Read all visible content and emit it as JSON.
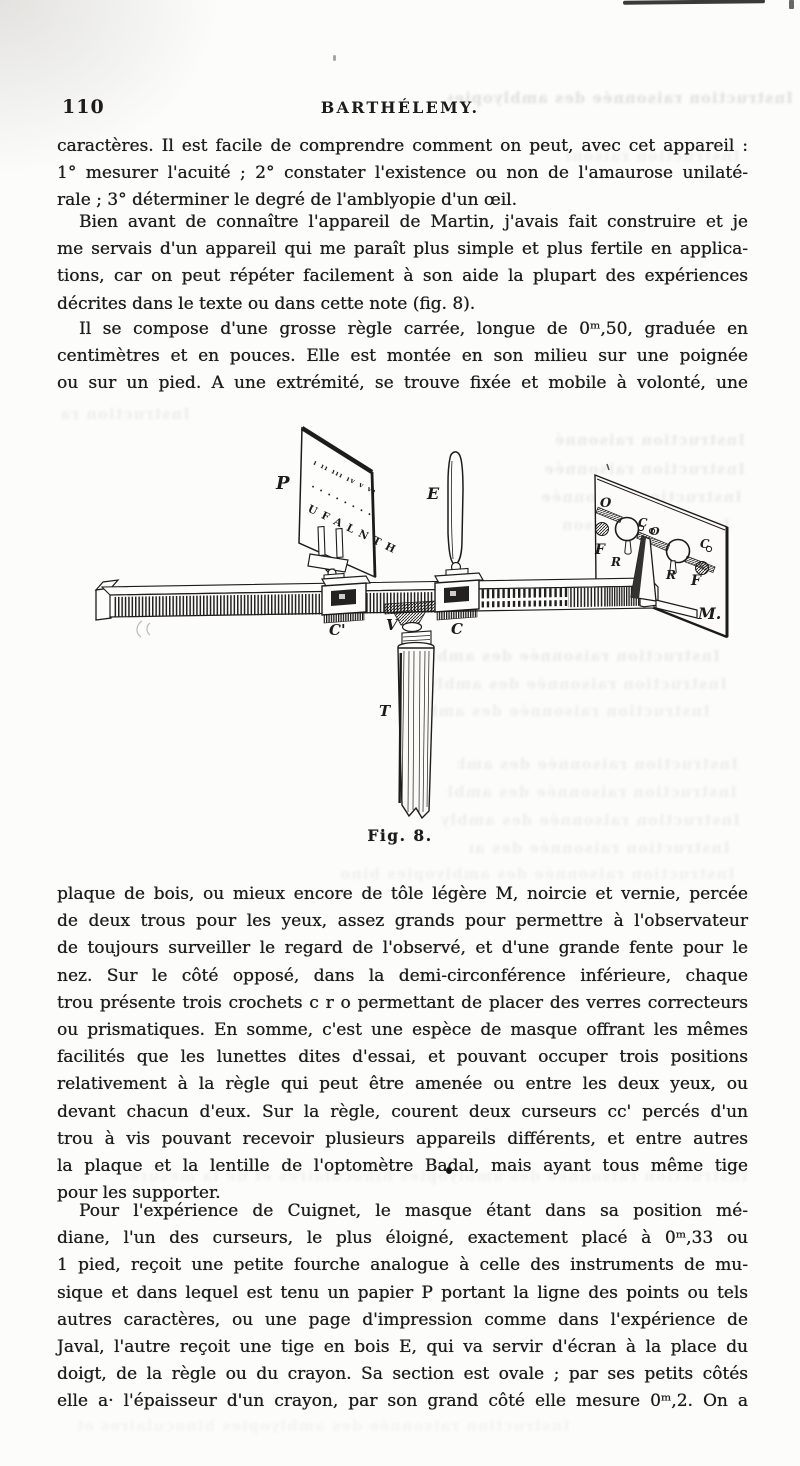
{
  "page": {
    "header": {
      "page_number": "110",
      "title": "BARTHÉLEMY."
    },
    "paragraphs": {
      "p1": {
        "lines": [
          "caractères. Il est facile de comprendre comment on peut, avec cet appareil :",
          "1° mesurer l'acuité ; 2° constater l'existence ou non de l'amaurose unilaté-",
          "rale ; 3° déterminer le degré de l'amblyopie d'un œil."
        ]
      },
      "p2": {
        "lines": [
          "Bien avant de connaître l'appareil de Martin, j'avais fait construire et je",
          "me servais d'un appareil qui me paraît plus simple et plus fertile en applica-",
          "tions, car on peut répéter facilement à son aide la plupart des expériences",
          "décrites dans le texte ou dans cette note (fig. 8)."
        ]
      },
      "p3": {
        "lines": [
          "Il se compose d'une grosse règle carrée, longue de 0ᵐ,50, graduée en",
          "centimètres et en pouces. Elle est montée en son milieu sur une poignée",
          "ou sur un pied. A une extrémité, se trouve fixée et mobile à volonté, une"
        ]
      },
      "p4": {
        "lines": [
          "plaque de bois, ou mieux encore de tôle légère M, noircie et vernie, percée",
          "de deux trous pour les yeux, assez grands pour permettre à l'observateur",
          "de toujours surveiller le regard de l'observé, et d'une grande fente pour le",
          "nez. Sur le côté opposé, dans la demi-circonférence inférieure, chaque",
          "trou présente trois crochets c r o permettant de placer des verres correcteurs",
          "ou prismatiques. En somme, c'est une espèce de masque offrant les mêmes",
          "facilités que les lunettes dites d'essai, et pouvant occuper trois positions",
          "relativement à la règle qui peut être amenée ou entre les deux yeux, ou",
          "devant chacun d'eux. Sur la règle, courent deux curseurs cc' percés d'un",
          "trou à vis pouvant recevoir plusieurs appareils différents, et entre autres",
          "la plaque et la lentille de l'optomètre Badal, mais ayant tous même tige",
          "pour les supporter."
        ]
      },
      "p5": {
        "lines": [
          "Pour l'expérience de Cuignet, le masque étant dans sa position mé-",
          "diane, l'un des curseurs, le plus éloigné, exactement placé à 0ᵐ,33 ou",
          "1 pied, reçoit une petite fourche analogue à celle des instruments de mu-",
          "sique et dans lequel est tenu un papier P portant la ligne des points ou tels",
          "autres caractères, ou une page d'impression comme dans l'expérience de",
          "Javal, l'autre reçoit une tige en bois E, qui va servir d'écran à la place du",
          "doigt, de la règle ou du crayon. Sa section est ovale ; par ses petits côtés",
          "elle a· l'épaisseur d'un crayon, par son grand côté elle mesure 0ᵐ,2. On a"
        ]
      }
    },
    "figure": {
      "caption": "Fig. 8.",
      "chart": {
        "row_numerals": "ı ıı ııı ıv v vı",
        "row_dots": "· · · · · · · ·",
        "row_letters": "U F A L N T H"
      },
      "labels": {
        "plate": "P",
        "screen_rod": "E",
        "cursor_left": "C'",
        "pivot": "V",
        "cursor_right": "C",
        "handle": "T",
        "mask": "M.",
        "o_left": "O",
        "f_left": "F",
        "r_left": "R",
        "c_mid": "C",
        "o_mid": "O",
        "c_right": "C",
        "r_right": "R",
        "f_right": "F"
      }
    },
    "bleed_text": "Instruction raisonnée des amblyopies binoculaires et de la mesure"
  }
}
